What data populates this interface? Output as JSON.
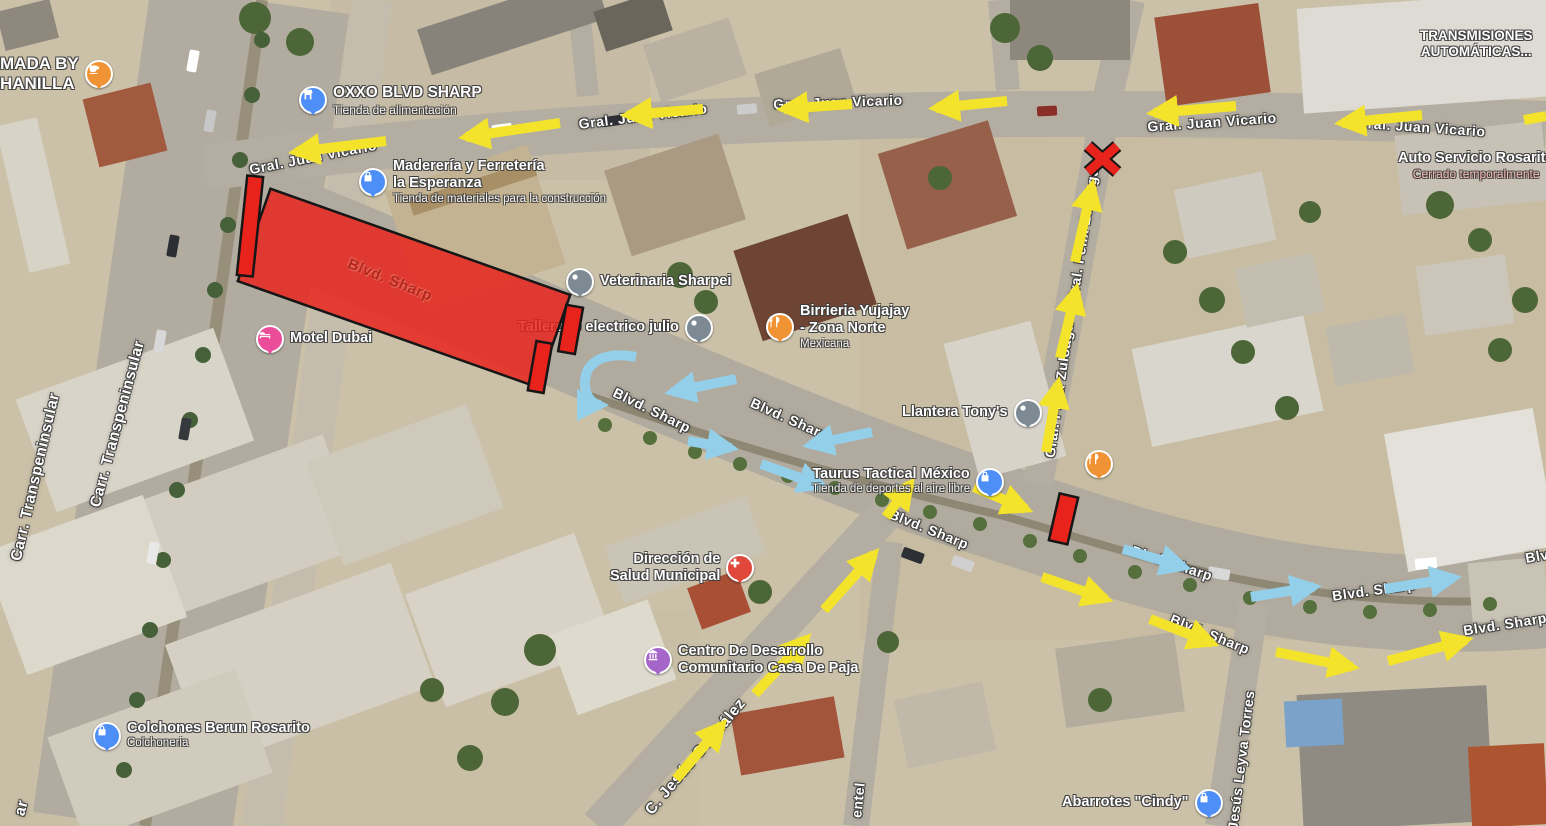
{
  "app": {
    "title": "Satellite map with traffic-flow annotations",
    "location_hint": "Blvd. Sharp / Gral. Juan Vicario area"
  },
  "colors": {
    "annotation_yellow": "#f3e32b",
    "annotation_blue": "#93cfe8",
    "annotation_red": "#e8231c",
    "annotation_outline": "#161616",
    "street_label": "#ffffff",
    "red_street_label": "#b3261b",
    "closed_status": "#f4b8b1",
    "poi_blue": "#4d8ef7",
    "poi_gray": "#7d8a94",
    "poi_orange": "#f09334",
    "poi_pink": "#ec4d9b",
    "poi_red": "#e0483b",
    "poi_purple": "#a565c9"
  },
  "streets": {
    "juan_vicario": "Gral. Juan Vicario",
    "blvd_sharp": "Blvd. Sharp",
    "blvd_sharp_partial": "Blv",
    "transpeninsular": "Carr. Transpeninsular",
    "transpeninsular_partial": "ar",
    "zuloaga": "Gral. Félix Zuloaga",
    "jesus_gonzalez": "C. Jesús González",
    "leyva_torres": "Jesús Leyva Torres",
    "pimentel_partial": "entel"
  },
  "annotations": {
    "blocked_area_label": "Blvd. Sharp"
  },
  "pois": {
    "chanilla": {
      "line1": "MADA BY",
      "line2": "HANILLA",
      "icon": "cafe-icon",
      "color": "#f09334"
    },
    "oxxo": {
      "name": "OXXO BLVD SHARP",
      "subtitle": "Tienda de alimentación",
      "icon": "store-icon",
      "color": "#4d8ef7"
    },
    "madereria": {
      "name": "Maderería y Ferretería",
      "name2": "la Esperanza",
      "subtitle": "Tienda de materiales para la construcción",
      "icon": "shopping-bag-icon",
      "color": "#4d8ef7"
    },
    "motel": {
      "name": "Motel Dubai",
      "icon": "bed-icon",
      "color": "#ec4d9b"
    },
    "veterinaria": {
      "name": "Veterinaria Sharpei",
      "icon": "dot-icon",
      "color": "#7d8a94"
    },
    "taller": {
      "name": "Tallercito electrico julio",
      "icon": "dot-icon",
      "color": "#7d8a94"
    },
    "birrieria": {
      "name": "Birrieria Yujajay",
      "name2": "- Zona Norte",
      "subtitle": "Mexicana",
      "icon": "restaurant-icon",
      "color": "#f09334"
    },
    "llantera": {
      "name": "Llantera Tony's",
      "icon": "dot-icon",
      "color": "#7d8a94"
    },
    "taurus": {
      "name": "Taurus Tactical México",
      "subtitle": "Tienda de deportes al aire libre",
      "icon": "shopping-bag-icon",
      "color": "#4d8ef7"
    },
    "salud": {
      "name": "Dirección de",
      "name2": "Salud Municipal",
      "icon": "health-icon",
      "color": "#e0483b"
    },
    "centro": {
      "name": "Centro De Desarrollo",
      "name2": "Comunitario Casa De Paja",
      "icon": "civic-icon",
      "color": "#a565c9"
    },
    "colchones": {
      "name": "Colchones Berun Rosarito",
      "subtitle": "Colchoneria",
      "icon": "shopping-bag-icon",
      "color": "#4d8ef7"
    },
    "transmisiones": {
      "name": "TRANSMISIONES",
      "name2": "AUTOMÁTICAS..."
    },
    "autoservicio": {
      "name": "Auto Servicio Rosarito",
      "subtitle": "Cerrado temporalmente"
    },
    "abarrotes": {
      "name": "Abarrotes \"Cindy\"",
      "icon": "shopping-bag-icon",
      "color": "#4d8ef7"
    },
    "food_stand": {
      "icon": "restaurant-icon",
      "color": "#f09334"
    }
  }
}
